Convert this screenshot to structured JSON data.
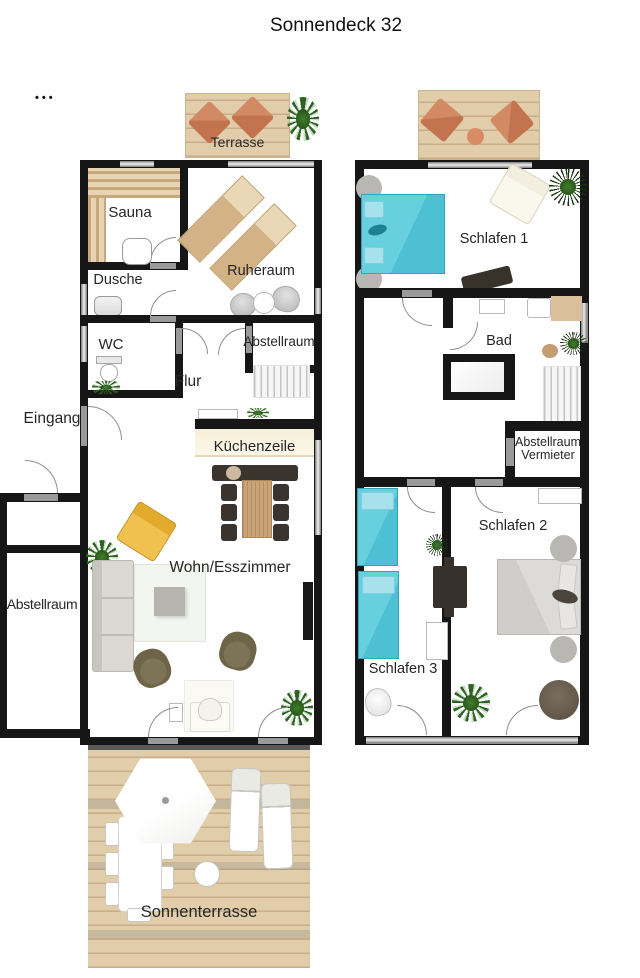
{
  "title": "Sonnendeck 32",
  "menu_dots": "•••",
  "ground_floor": {
    "terrace": "Terrasse",
    "sauna": "Sauna",
    "relax_room": "Ruheraum",
    "shower": "Dusche",
    "wc": "WC",
    "storage": "Abstellraum",
    "hall": "Flur",
    "entrance": "Eingang",
    "kitchenette": "Küchenzeile",
    "living_dining": "Wohn/Esszimmer",
    "outside_storage": "Abstellraum",
    "sun_terrace": "Sonnenterrasse"
  },
  "upper_floor": {
    "bedroom1": "Schlafen 1",
    "hall": "Diele",
    "bath": "Bad",
    "landlord_storage_line1": "Abstellraum",
    "landlord_storage_line2": "Vermieter",
    "bedroom2": "Schlafen 2",
    "bedroom3": "Schlafen 3"
  },
  "colors": {
    "wall": "#161616",
    "door_window_grey": "#9a9a9a",
    "deck_wood": "#e2cdab",
    "terrace_cushion_orange": "#c97c55",
    "teal_bed": "#56c5d8",
    "grey_bed": "#d5d3d0",
    "yellow_armchair": "#e3ab2b",
    "olive_armchair": "#6e6449",
    "dining_set_dark": "#3a332d",
    "table_wood": "#c8a478",
    "plant_green": "#2d6322"
  }
}
